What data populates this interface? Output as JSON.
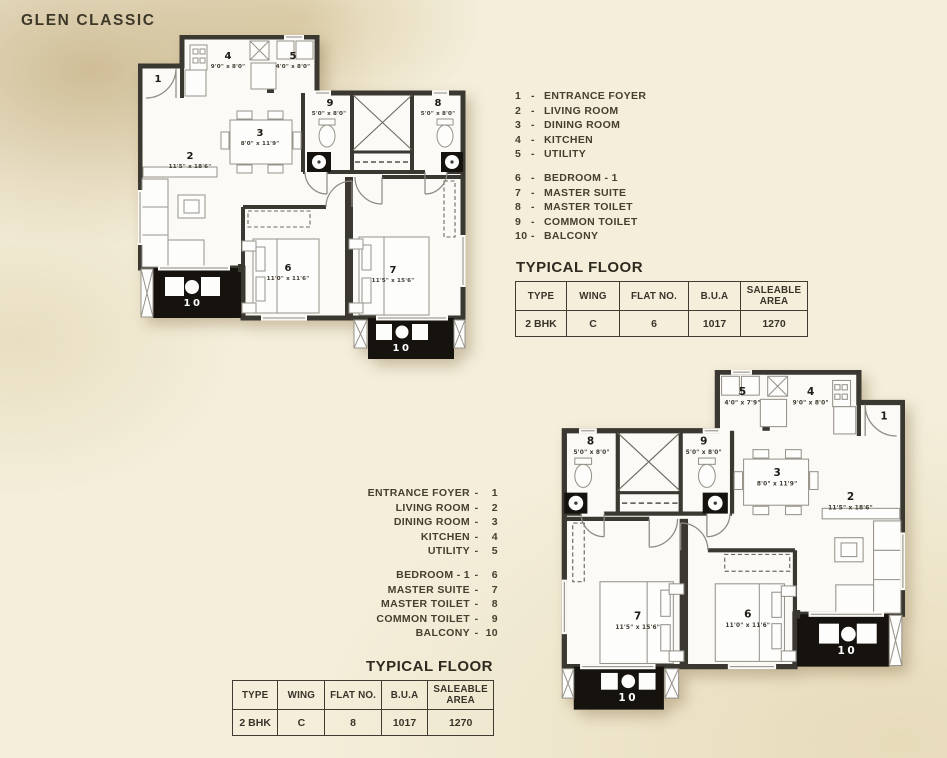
{
  "title": "GLEN CLASSIC",
  "legend": {
    "sep": "-",
    "items": [
      {
        "num": "1",
        "name": "ENTRANCE FOYER"
      },
      {
        "num": "2",
        "name": "LIVING ROOM"
      },
      {
        "num": "3",
        "name": "DINING ROOM"
      },
      {
        "num": "4",
        "name": "KITCHEN"
      },
      {
        "num": "5",
        "name": "UTILITY"
      },
      {
        "num": "6",
        "name": "BEDROOM - 1"
      },
      {
        "num": "7",
        "name": "MASTER SUITE"
      },
      {
        "num": "8",
        "name": "MASTER TOILET"
      },
      {
        "num": "9",
        "name": "COMMON TOILET"
      },
      {
        "num": "10",
        "name": "BALCONY"
      }
    ]
  },
  "table_headers": [
    "TYPE",
    "WING",
    "FLAT NO.",
    "B.U.A",
    "SALEABLE AREA"
  ],
  "floor_tables": {
    "plan1": {
      "heading": "TYPICAL FLOOR",
      "type": "2 BHK",
      "wing": "C",
      "flat_no": "6",
      "bua": "1017",
      "saleable": "1270"
    },
    "plan2": {
      "heading": "TYPICAL FLOOR",
      "type": "2 BHK",
      "wing": "C",
      "flat_no": "8",
      "bua": "1017",
      "saleable": "1270"
    }
  },
  "plans": {
    "plan1": {
      "rooms": {
        "r1": {
          "num": "1"
        },
        "r2": {
          "num": "2",
          "dims": "11'5\" x 18'6\""
        },
        "r3": {
          "num": "3",
          "dims": "8'0\" x 11'9\""
        },
        "r4": {
          "num": "4",
          "dims": "9'0\" x 8'0\""
        },
        "r5": {
          "num": "5",
          "dims": "4'0\" x 8'0\""
        },
        "r6": {
          "num": "6",
          "dims": "11'0\" x 11'6\""
        },
        "r7": {
          "num": "7",
          "dims": "11'5\" x 15'6\""
        },
        "r8": {
          "num": "8",
          "dims": "5'0\" x 8'0\""
        },
        "r9": {
          "num": "9",
          "dims": "5'0\" x 8'0\""
        },
        "r10": {
          "num": "10"
        }
      }
    },
    "plan2": {
      "rooms": {
        "r1": {
          "num": "1"
        },
        "r2": {
          "num": "2",
          "dims": "11'5\" x 18'6\""
        },
        "r3": {
          "num": "3",
          "dims": "8'0\" x 11'9\""
        },
        "r4": {
          "num": "4",
          "dims": "9'0\" x 8'0\""
        },
        "r5": {
          "num": "5",
          "dims": "4'0\" x 7'9\""
        },
        "r6": {
          "num": "6",
          "dims": "11'0\" x 11'6\""
        },
        "r7": {
          "num": "7",
          "dims": "11'5\" x 15'6\""
        },
        "r8": {
          "num": "8",
          "dims": "5'0\" x 8'0\""
        },
        "r9": {
          "num": "9",
          "dims": "5'0\" x 8'0\""
        },
        "r10": {
          "num": "10"
        }
      }
    }
  },
  "colors": {
    "wall": "#3b3831",
    "balcony_fill": "#16130f",
    "background": "#f4eeda",
    "title_text": "#3e3829"
  }
}
